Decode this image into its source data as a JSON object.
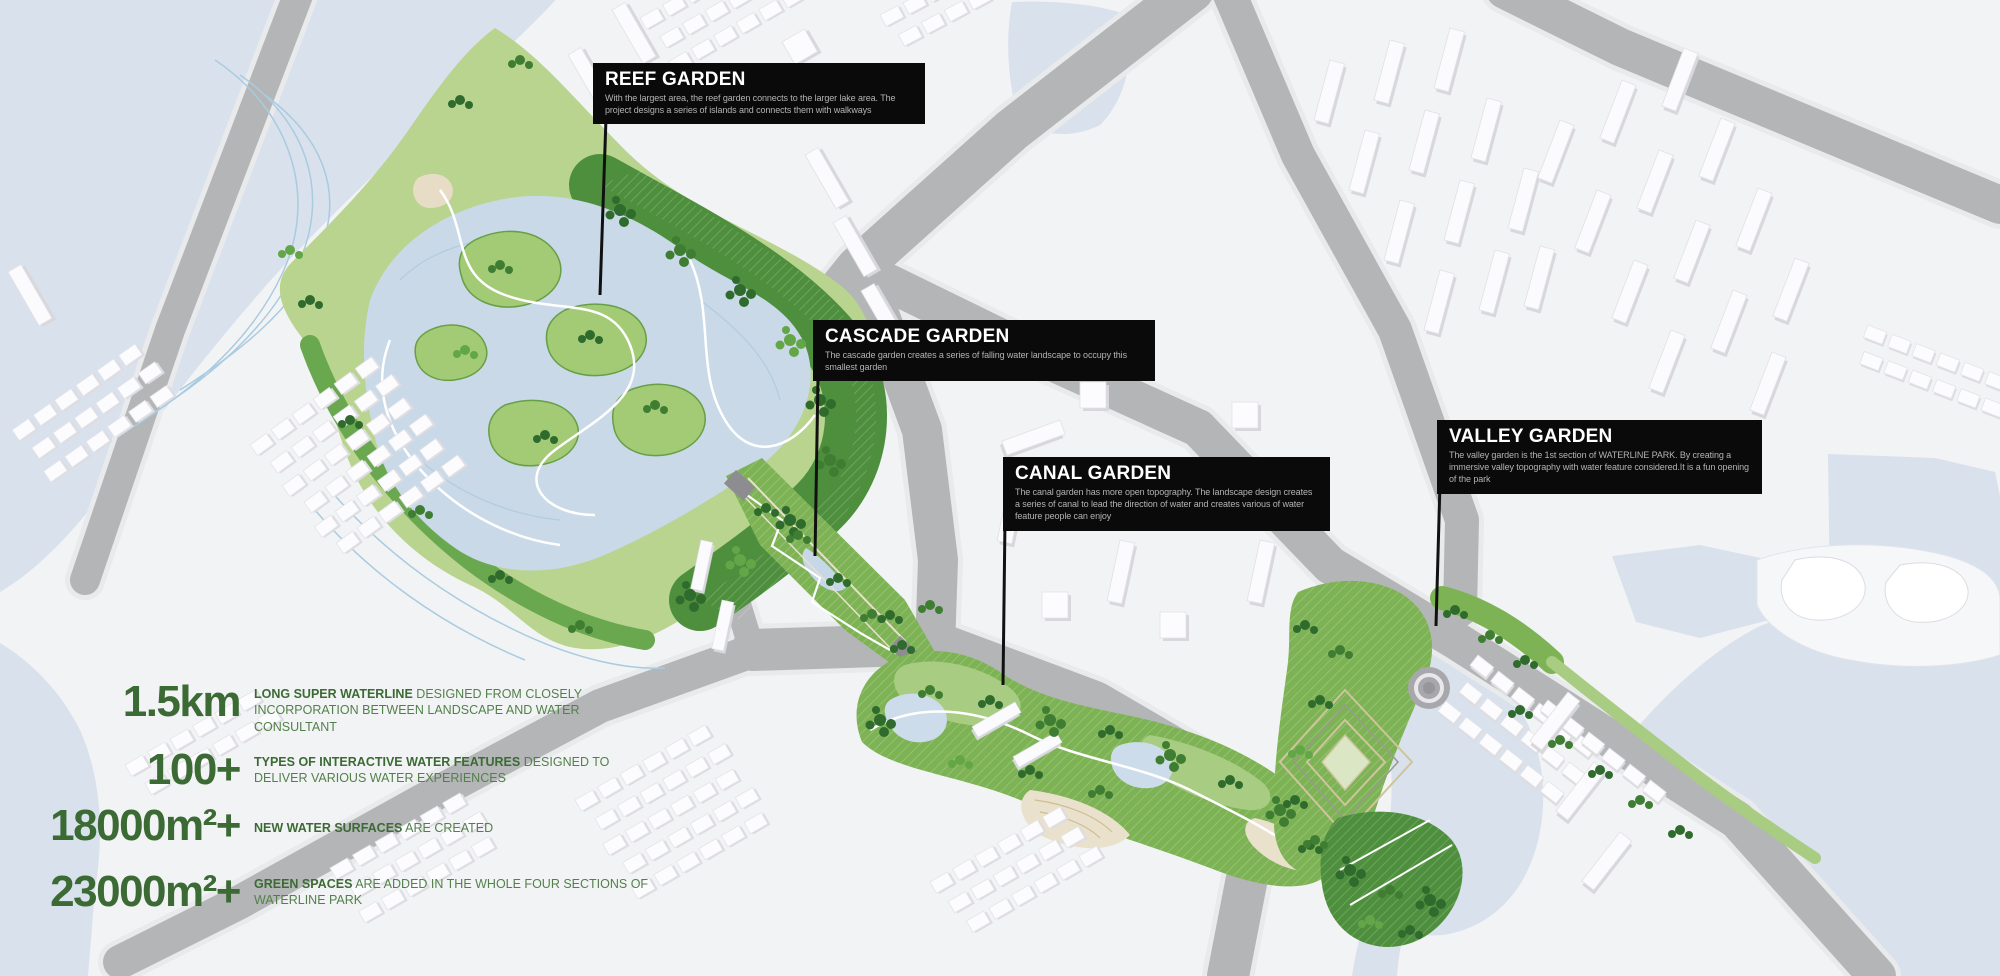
{
  "callouts": [
    {
      "id": "reef",
      "title": "REEF GARDEN",
      "description": "With the largest area, the reef garden connects to the larger lake area. The project designs a series of islands and connects them with walkways"
    },
    {
      "id": "cascade",
      "title": "CASCADE GARDEN",
      "description": "The cascade garden creates a series of falling water landscape to occupy this smallest garden"
    },
    {
      "id": "canal",
      "title": "CANAL GARDEN",
      "description": "The canal garden has more open topography. The landscape design creates a series of canal to lead the direction of water and creates various of water feature people can enjoy"
    },
    {
      "id": "valley",
      "title": "VALLEY GARDEN",
      "description": "The valley garden is the 1st section of WATERLINE PARK. By creating a immersive valley topography with water feature considered.It is a fun opening of the park"
    }
  ],
  "stats": [
    {
      "value": "1.5km",
      "highlight": "LONG SUPER WATERLINE",
      "rest": " DESIGNED FROM CLOSELY INCORPORATION BETWEEN LANDSCAPE AND WATER CONSULTANT"
    },
    {
      "value": "100+",
      "highlight": "TYPES OF INTERACTIVE WATER FEATURES",
      "rest": " DESIGNED TO DELIVER VARIOUS WATER EXPERIENCES"
    },
    {
      "value": "18000m²+",
      "highlight": "NEW WATER SURFACES",
      "rest": " ARE CREATED"
    },
    {
      "value": "23000m²+",
      "highlight": "GREEN SPACES",
      "rest": " ARE ADDED IN THE WHOLE FOUR SECTIONS OF WATERLINE PARK"
    }
  ],
  "colors": {
    "water": "#d9e1ed",
    "land": "#f2f3f5",
    "road": "#b4b5b7",
    "garden_green": "#7db354",
    "forest_green": "#4e8f3d",
    "tree_green": "#2f6b2d",
    "callout_bg": "#0a0a0a",
    "callout_title": "#ffffff",
    "callout_body": "#b3b3b3",
    "stat_green": "#3c6a34"
  }
}
